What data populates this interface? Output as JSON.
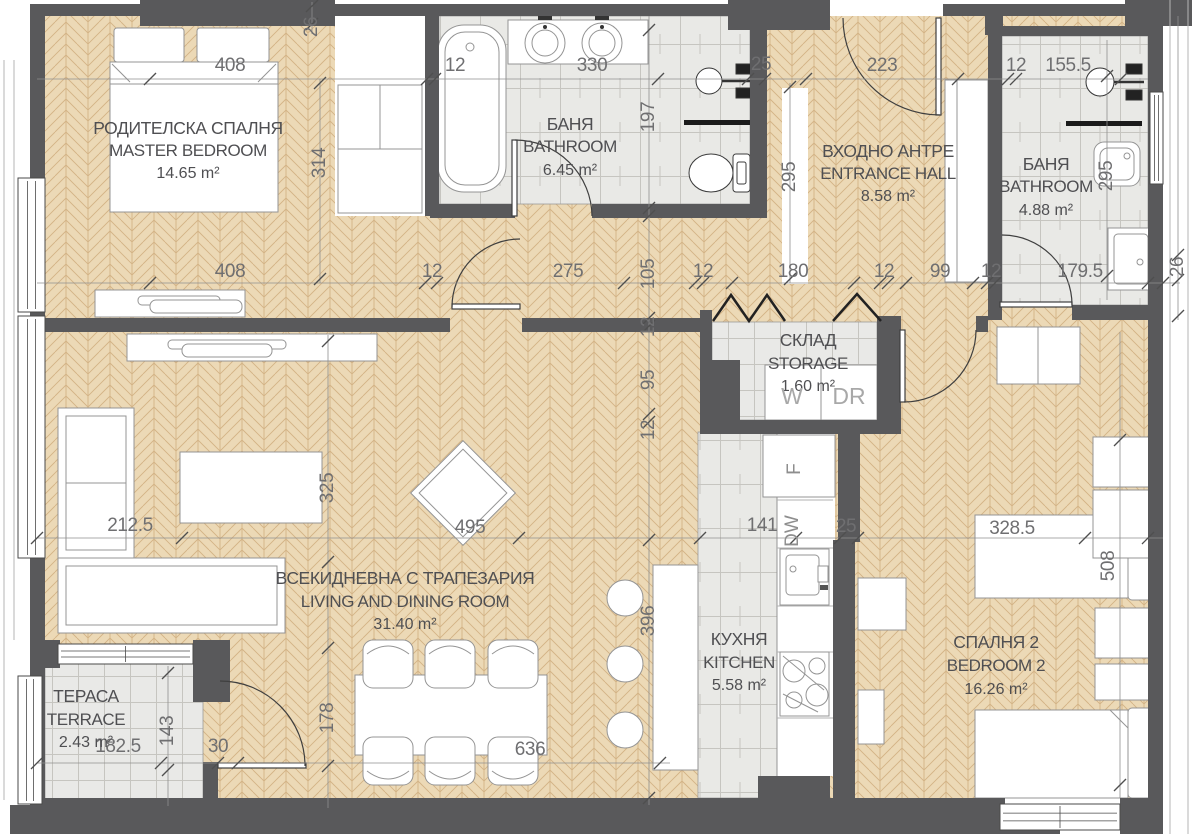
{
  "plan": {
    "rooms": [
      {
        "id": "master-bedroom",
        "name_bg": "РОДИТЕЛСКА СПАЛНЯ",
        "name_en": "MASTER BEDROOM",
        "area": "14.65 m²"
      },
      {
        "id": "bathroom-1",
        "name_bg": "БАНЯ",
        "name_en": "BATHROOM",
        "area": "6.45 m²"
      },
      {
        "id": "entrance-hall",
        "name_bg": "ВХОДНО АНТРЕ",
        "name_en": "ENTRANCE HALL",
        "area": "8.58 m²"
      },
      {
        "id": "bathroom-2",
        "name_bg": "БАНЯ",
        "name_en": "BATHROOM",
        "area": "4.88 m²"
      },
      {
        "id": "storage",
        "name_bg": "СКЛАД",
        "name_en": "STORAGE",
        "area": "1.60 m²"
      },
      {
        "id": "living-dining",
        "name_bg": "ВСЕКИДНЕВНА С ТРАПЕЗАРИЯ",
        "name_en": "LIVING AND DINING ROOM",
        "area": "31.40 m²"
      },
      {
        "id": "kitchen",
        "name_bg": "КУХНЯ",
        "name_en": "KITCHEN",
        "area": "5.58 m²"
      },
      {
        "id": "bedroom-2",
        "name_bg": "СПАЛНЯ 2",
        "name_en": "BEDROOM 2",
        "area": "16.26 m²"
      },
      {
        "id": "terrace",
        "name_bg": "ТЕРАСА",
        "name_en": "TERRACE",
        "area": "2.43 m²"
      }
    ],
    "appliances": [
      {
        "id": "washer",
        "label": "W"
      },
      {
        "id": "dryer",
        "label": "DR"
      },
      {
        "id": "fridge",
        "label": "F"
      },
      {
        "id": "dishwasher",
        "label": "DW"
      }
    ],
    "dimensions": [
      "408",
      "12",
      "330",
      "25",
      "223",
      "12",
      "155.5",
      "26",
      "314",
      "197",
      "295",
      "295",
      "408",
      "12",
      "275",
      "105",
      "12",
      "180",
      "12",
      "99",
      "12",
      "179.5",
      "26",
      "12",
      "95",
      "12",
      "325",
      "212.5",
      "495",
      "141",
      "25",
      "328.5",
      "508",
      "396",
      "178",
      "636",
      "182.5",
      "143",
      "30"
    ],
    "colors": {
      "wall": "#59595b",
      "wood_floor": "#ecd9b6",
      "wood_line": "#c79f6b",
      "tile_floor": "#e9e9e6",
      "tile_line": "#c6c5c0",
      "dimension_text": "#6f6f71",
      "label_text": "#4f4f52",
      "fixture_stroke": "#949494",
      "dark_fixture": "#222222"
    }
  }
}
